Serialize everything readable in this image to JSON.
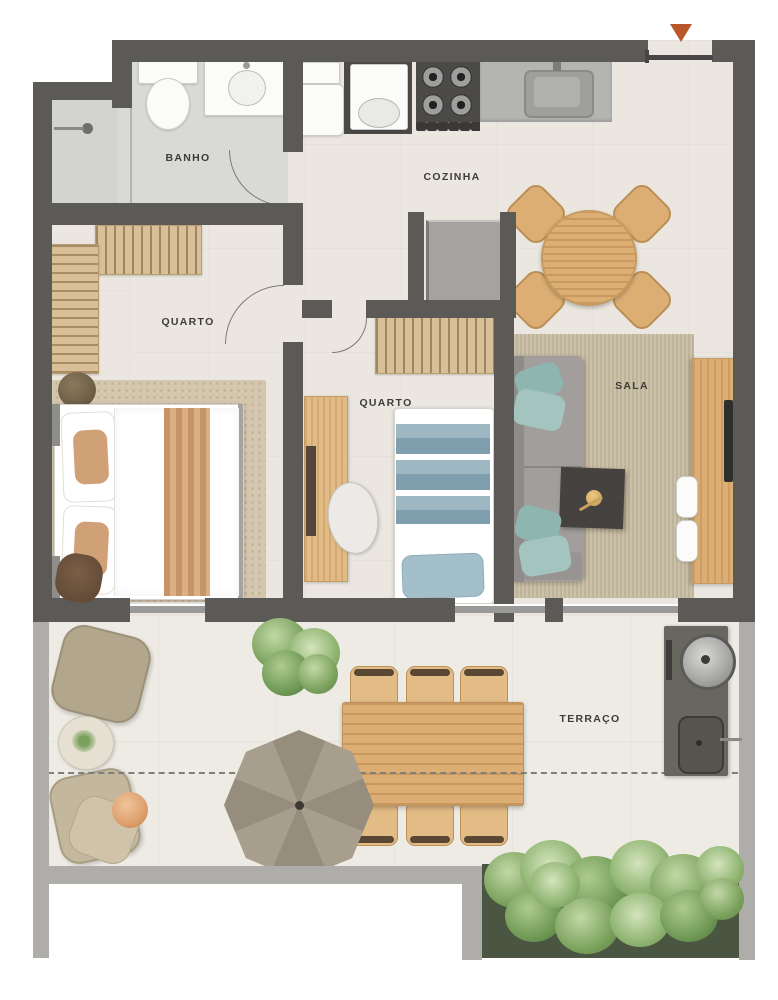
{
  "plan_title": "apartment floor plan",
  "rooms": {
    "banho": "BANHO",
    "cozinha": "COZINHA",
    "quarto_1": "QUARTO",
    "quarto_2": "QUARTO",
    "sala": "SALA",
    "terraco": "TERRAÇO"
  },
  "icons": {
    "entrance_marker": "entrance-arrow"
  },
  "colors": {
    "wall_dark": "#5c5a57",
    "wall_light": "#aeadaa",
    "glass_gray": "#9a9a98",
    "floor_main": "#ebe7e0",
    "floor_bath": "#d9d9d7",
    "floor_terrace": "#edebe4",
    "fixture_white": "#fbfbfa",
    "counter_gray": "#b4b4b2",
    "appliance_dark": "#4b4a48",
    "wood": "#dcae74",
    "wood_light": "#e2bb85",
    "wood_closet": "#d9bf97",
    "rug_beige": "#d5c6ae",
    "rug_sala": "#cbc0a8",
    "sofa_gray": "#a19e9b",
    "pillow_teal": "#8fb5b1",
    "bed_blue": "#9db8c3",
    "bed_blue_dark": "#7f9fae",
    "pouf_tan": "#b2a68c",
    "ball_orange": "#dd9f6d",
    "grill_dark": "#67665f",
    "entrance_orange": "#b9572b",
    "label_ink": "#3d3c39"
  }
}
